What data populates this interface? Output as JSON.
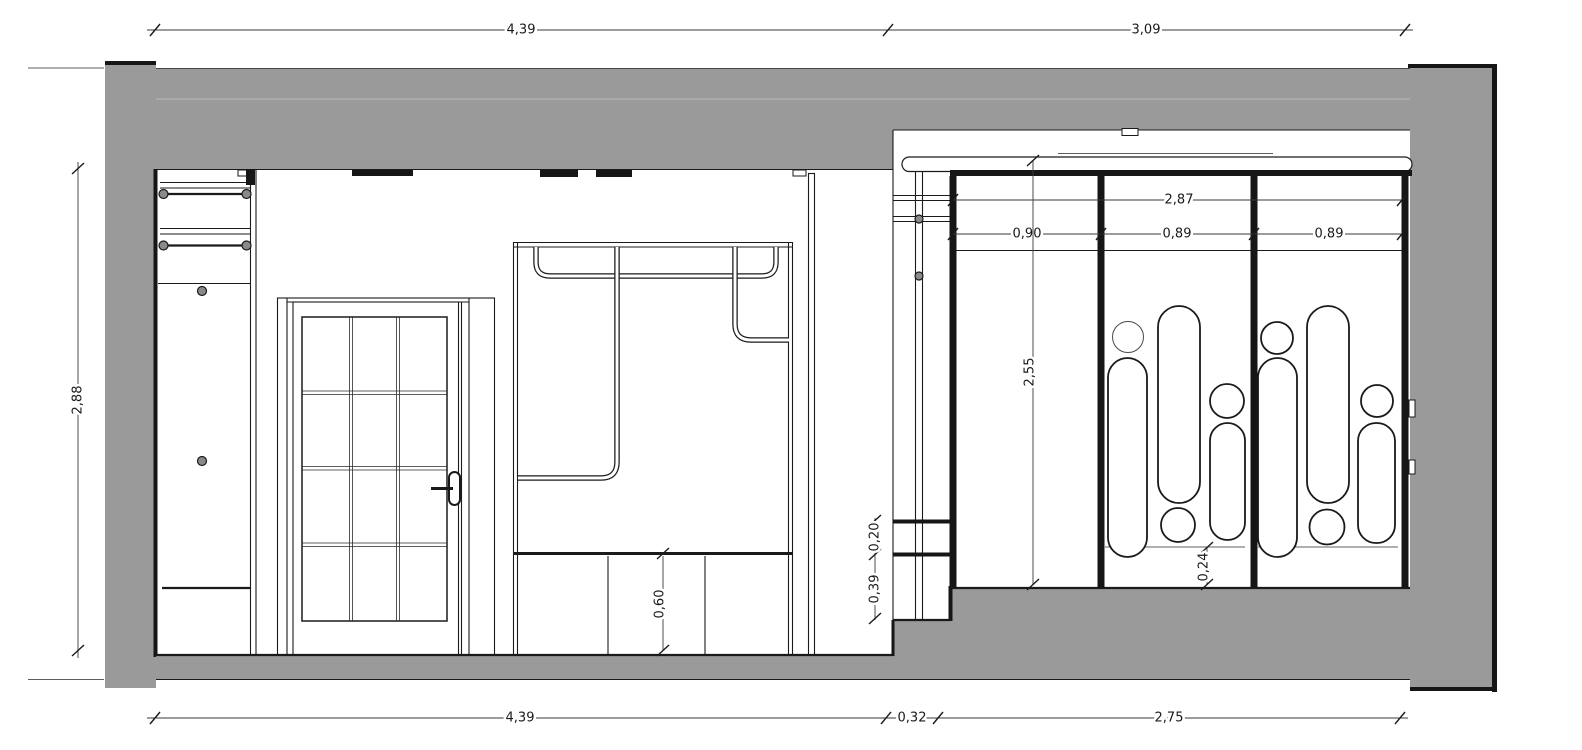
{
  "colors": {
    "wall_fill": "#9a9a9a",
    "wall_joint": "#b5b5b5",
    "line": "#1a1a1a",
    "dim_line": "#3a3a3a",
    "background": "#ffffff"
  },
  "dims": {
    "top_left": "4,39",
    "top_right": "3,09",
    "left_height": "2,88",
    "bottom_left": "4,39",
    "bottom_step": "0,32",
    "bottom_right": "2,75",
    "closet_width": "2,87",
    "closet_bay_1": "0,90",
    "closet_bay_2": "0,89",
    "closet_bay_3": "0,89",
    "closet_height": "2,55",
    "closet_plinth": "0,24",
    "step_upper": "0,20",
    "step_lower": "0,39",
    "cabinet_height": "0,60"
  }
}
